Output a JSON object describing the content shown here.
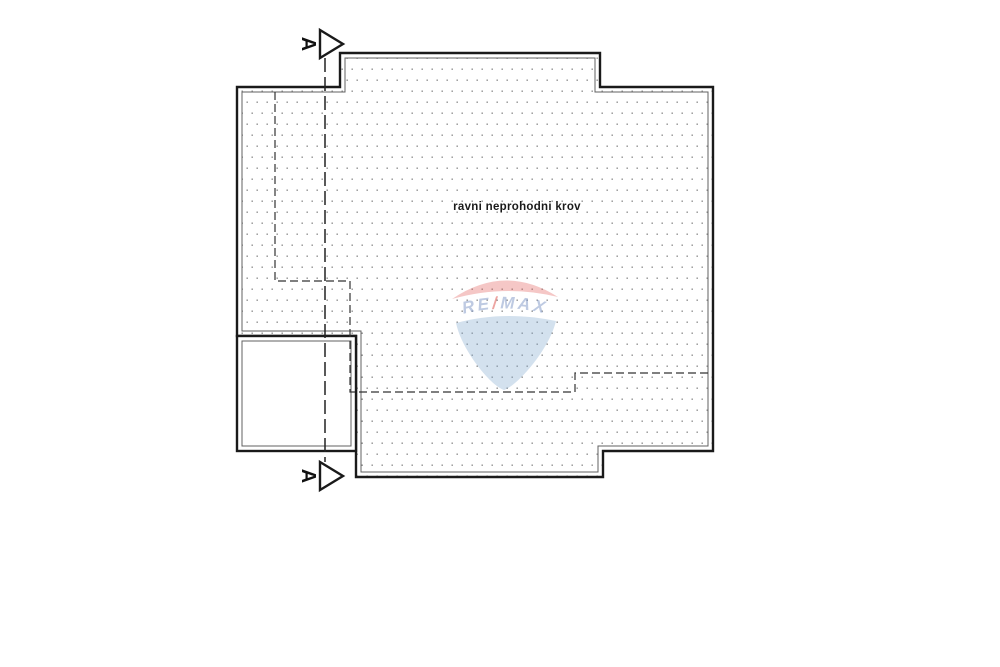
{
  "document": {
    "roof_label": "ravni neprohodni krov",
    "section": {
      "letter": "A"
    },
    "colors": {
      "outline": "#1a1a1a",
      "inner_line": "#606060",
      "hidden_edge": "#333333",
      "section_line": "#222222",
      "stipple_dot": "#8c8c8c",
      "background": "#ffffff"
    }
  },
  "watermark": {
    "brand_left": "RE",
    "brand_slash": "/",
    "brand_right": "MAX",
    "balloon_red": "#dd4b45",
    "balloon_blue": "#7fa7cd",
    "text_color": "#7d95c5"
  }
}
